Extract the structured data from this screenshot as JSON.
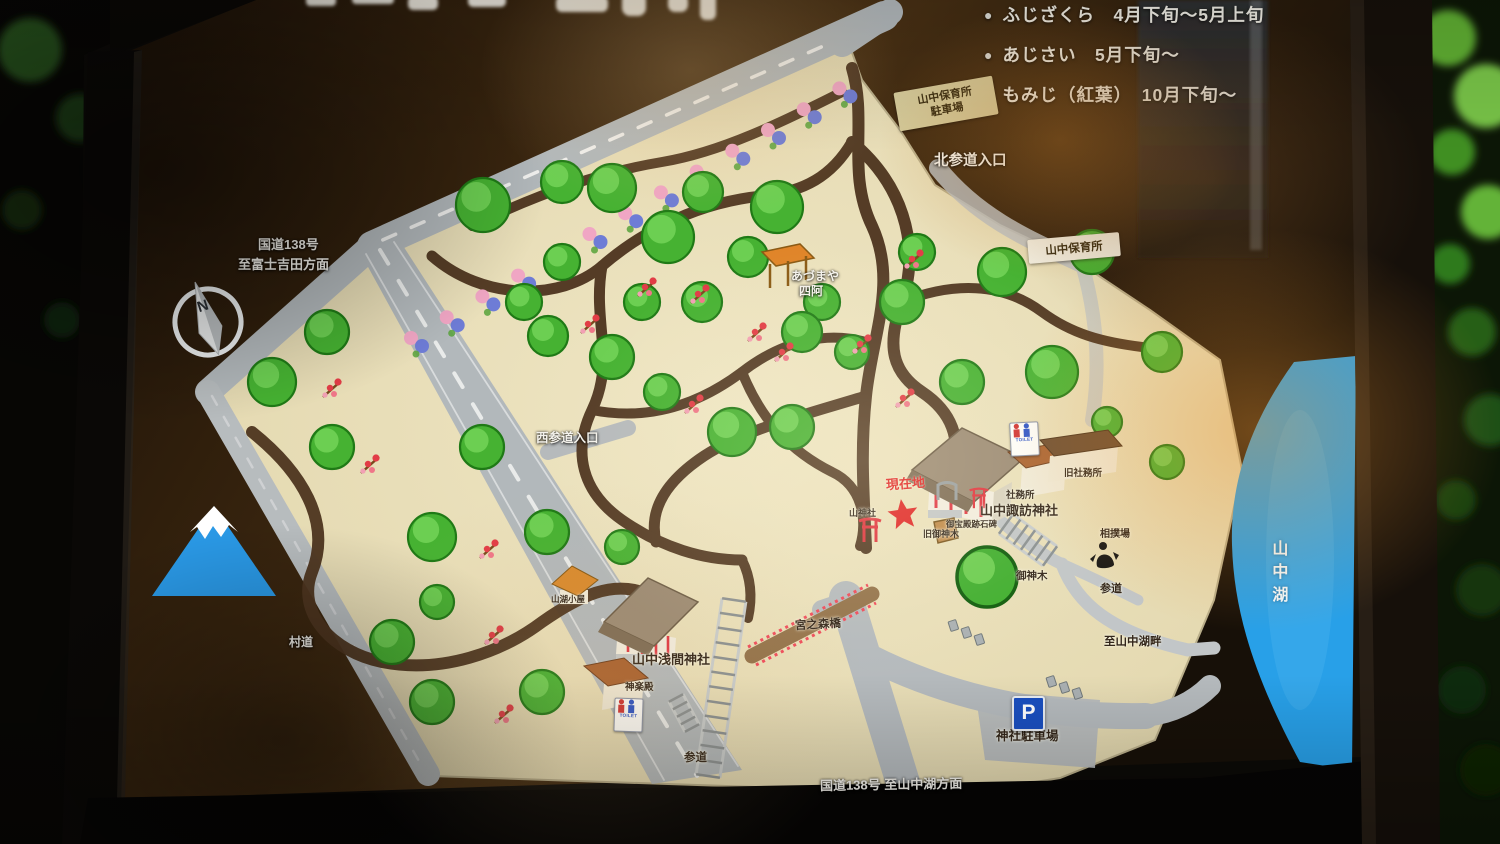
{
  "colors": {
    "lake_blue": "#28a0e8",
    "map_beige": "#e9dfba",
    "path_brown": "#4f3620",
    "road_gray": "#b5babd",
    "accent_red": "#e02828",
    "tree_green": "#3fae2e",
    "board_brown": "#3a2713",
    "frame_black": "#0a0806"
  },
  "legend": {
    "rows": [
      {
        "bullet": "●",
        "text": "ふじざくら　4月下旬～5月上旬"
      },
      {
        "bullet": "●",
        "text": "あじさい　5月下旬～"
      },
      {
        "bullet": "●",
        "text": "もみじ（紅葉）　10月下旬～"
      }
    ]
  },
  "boxes": {
    "nursery_parking": {
      "line1": "山中保育所",
      "line2": "駐車場"
    },
    "nursery": {
      "text": "山中保育所"
    }
  },
  "labels": {
    "route138_nw_line1": "国道138号",
    "route138_nw_line2": "至富士吉田方面",
    "kita_sando": "北参道入口",
    "nishi_sando": "西参道入口",
    "azumaya_kana": "あづまや",
    "azumaya_kanji": "四阿",
    "genzaichi": "現在地",
    "yama_jinja": "山神社",
    "suwa_jinja": "山中諏訪神社",
    "shamusho": "社務所",
    "kyu_shamusho": "旧社務所",
    "stone_monument": "御宝殿跡石碑",
    "kyu_goshinboku": "旧御神木",
    "sumo_ring": "相撲場",
    "goshinboku": "御神木",
    "sando_east": "参道",
    "to_lakeside": "至山中湖畔",
    "bridge": "宮之森橋",
    "sengen_jinja": "山中浅間神社",
    "kagura_den": "神楽殿",
    "mountain_hut": "山湖小屋",
    "sondo": "村道",
    "sando_south": "参道",
    "route138_s": "国道138号 至山中湖方面",
    "lake": "山中湖"
  },
  "signs": {
    "toilet": "TOILET",
    "parking_letter": "P",
    "parking_label": "神社駐車場",
    "compass_n": "N"
  }
}
